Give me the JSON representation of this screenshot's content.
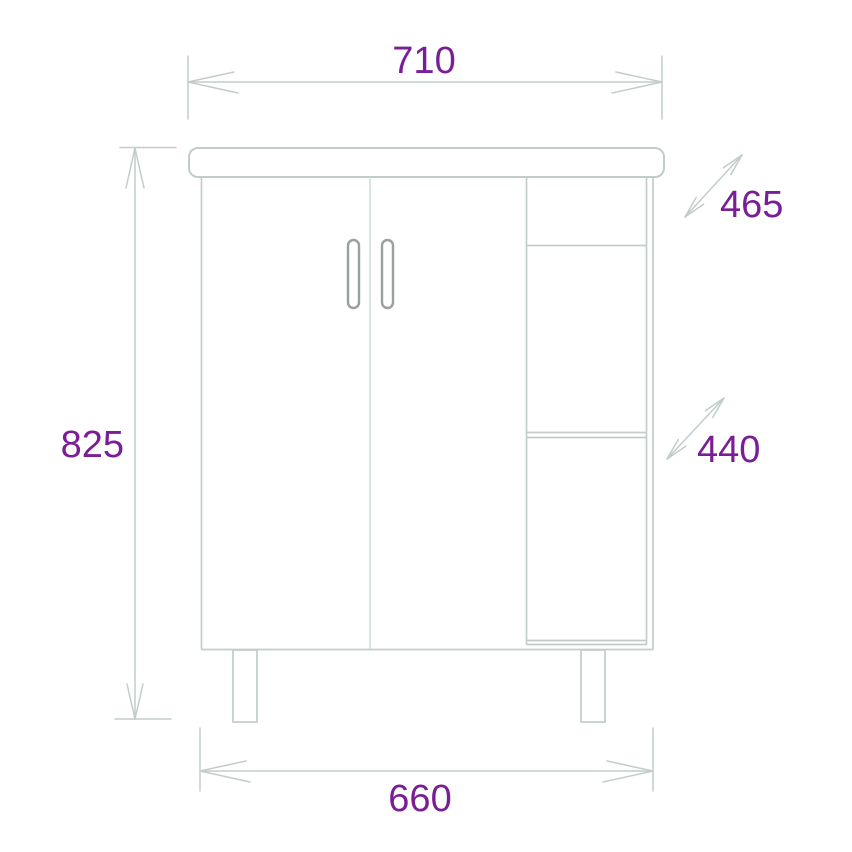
{
  "figure": {
    "type": "technical-drawing",
    "subject": "vanity cabinet front elevation with two doors, side open shelves and legs"
  },
  "dimensions": {
    "top_width": "710",
    "height": "825",
    "bottom_width": "660",
    "upper_diagonal_depth": "465",
    "lower_diagonal_depth": "440"
  },
  "colors": {
    "line": "#c2cdc9",
    "divider_line": "#cfe1d8",
    "handle": "#9aa0a0",
    "dimension_text": "#7a1e96",
    "background": "#ffffff"
  }
}
